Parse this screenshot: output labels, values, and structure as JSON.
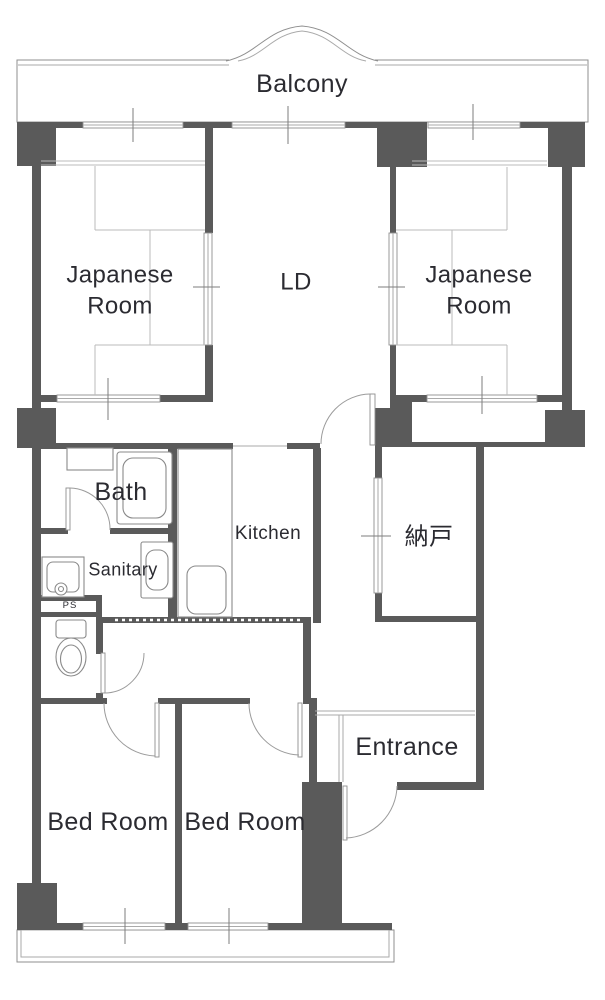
{
  "document": {
    "type": "apartment-floor-plan"
  },
  "colors": {
    "wall": "#5a5a5a",
    "line": "#8f8f8f",
    "line_light": "#aaaaaa",
    "tatami_line": "#bbbbbb",
    "text": "#2b2b31",
    "background": "#ffffff"
  },
  "labels": {
    "balcony": "Balcony",
    "japanese_room_left": "Japanese Room",
    "living_dining": "LD",
    "japanese_room_right": "Japanese Room",
    "bath": "Bath",
    "kitchen": "Kitchen",
    "sanitary": "Sanitary",
    "storage": "納戸",
    "pipe_space": "PS",
    "entrance": "Entrance",
    "bedroom_left": "Bed Room",
    "bedroom_right": "Bed Room"
  },
  "icons": {
    "fixtures": [
      "bathtub",
      "wash-basin",
      "washing-machine",
      "vanity-sink",
      "toilet",
      "gas-stove",
      "kitchen-sink"
    ]
  }
}
